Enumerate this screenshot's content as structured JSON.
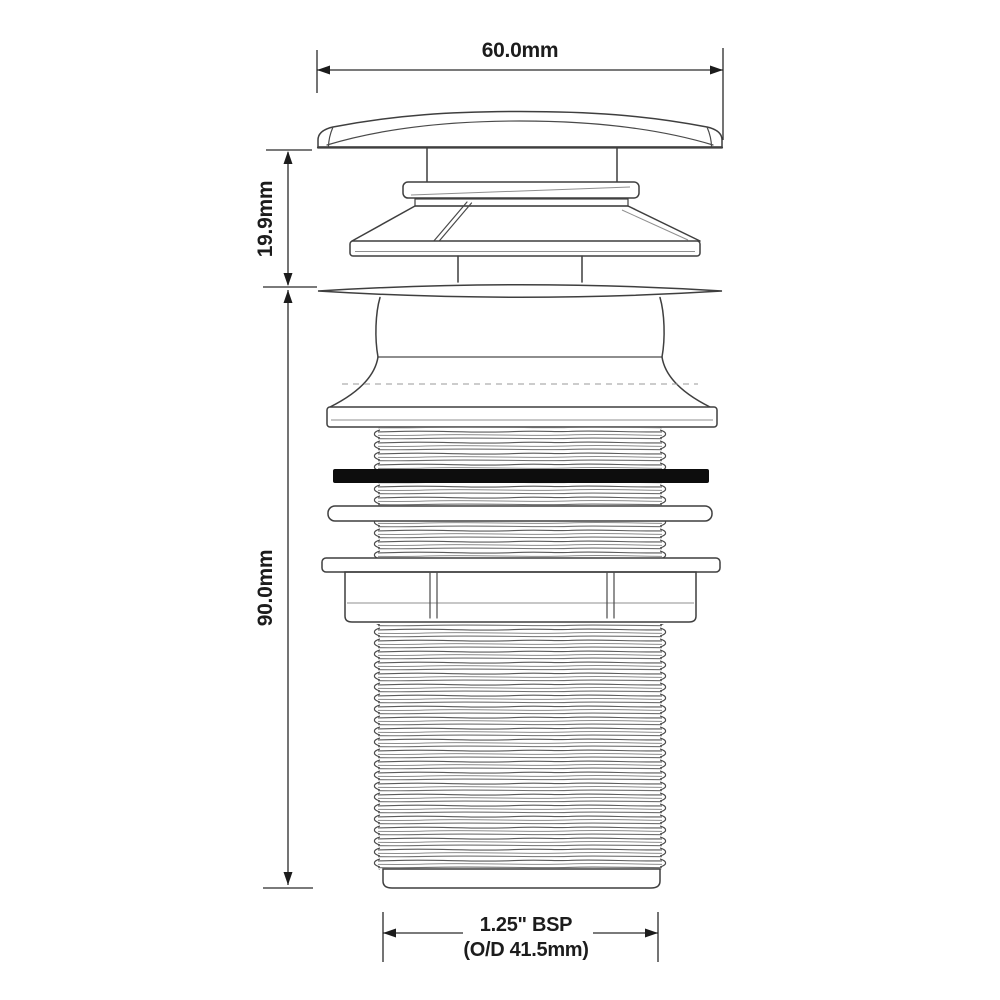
{
  "dims": {
    "width": "60.0mm",
    "cap_height": "19.9mm",
    "body_height": "90.0mm",
    "thread_size": "1.25\" BSP",
    "thread_od": "(O/D 41.5mm)"
  },
  "colors": {
    "line": "#3f3f3f",
    "dimension": "#1c1c1c",
    "gasket": "#0d0d0d",
    "background": "#ffffff"
  }
}
